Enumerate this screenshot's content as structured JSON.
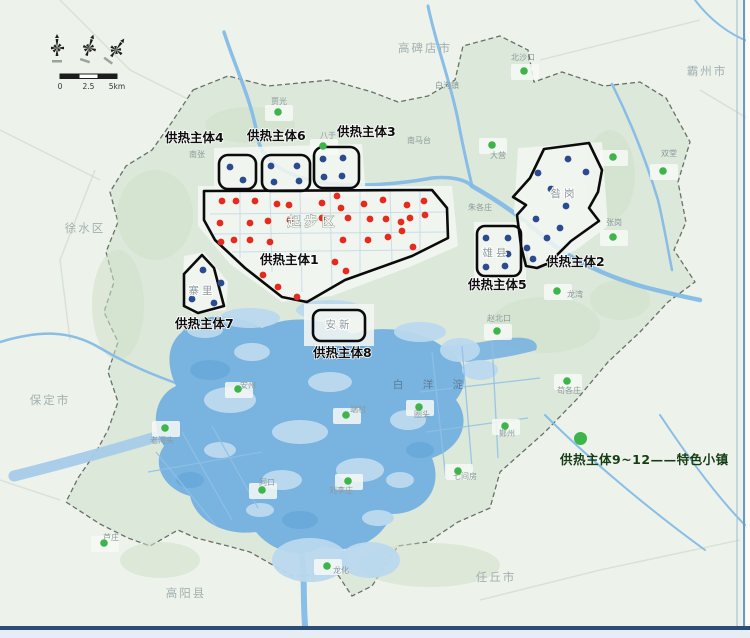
{
  "colors": {
    "bg_outside": "#edf2ea",
    "bg_inside": "#dce8da",
    "texture": "#cfe0ca",
    "built": "#f3f6f1",
    "water": "#79b3e0",
    "water_light": "#b9d8ee",
    "water_deep": "#63a6d8",
    "river": "#84bbe6",
    "canal_band": "#a6cbe9",
    "boundary": "#6a6f6a",
    "zone_stroke": "#0b0b0b",
    "red_dot": "#e42b1e",
    "blue_dot": "#2c4a8e",
    "green_dot": "#3db54a",
    "zone_label": "#0d0d0d",
    "city_label": "#a2b0b2",
    "town_label": "#8b9a9b",
    "area_label": "#8d9a9e",
    "lake_label": "#5c7a94",
    "legend_text": "#153d15",
    "frame_dark": "#2c4d74",
    "frame_light": "#6d99c4"
  },
  "legend": {
    "text": "供热主体9~12——特色小镇"
  },
  "scalebar": {
    "ticks": [
      "0",
      "2.5",
      "5km"
    ]
  },
  "zone_labels": [
    {
      "text": "供热主体4",
      "x": 165,
      "y": 142
    },
    {
      "text": "供热主体6",
      "x": 247,
      "y": 140
    },
    {
      "text": "供热主体3",
      "x": 337,
      "y": 136
    },
    {
      "text": "供热主体1",
      "x": 260,
      "y": 264
    },
    {
      "text": "供热主体7",
      "x": 175,
      "y": 328
    },
    {
      "text": "供热主体8",
      "x": 313,
      "y": 357
    },
    {
      "text": "供热主体5",
      "x": 468,
      "y": 289
    },
    {
      "text": "供热主体2",
      "x": 546,
      "y": 266
    }
  ],
  "city_labels": [
    {
      "text": "高碑店市",
      "x": 425,
      "y": 52
    },
    {
      "text": "霸州市",
      "x": 707,
      "y": 75
    },
    {
      "text": "徐水区",
      "x": 85,
      "y": 232
    },
    {
      "text": "保定市",
      "x": 50,
      "y": 404
    },
    {
      "text": "高阳县",
      "x": 186,
      "y": 597
    },
    {
      "text": "任丘市",
      "x": 496,
      "y": 581
    }
  ],
  "area_labels": [
    {
      "text": "起步区",
      "x": 313,
      "y": 226,
      "big": true
    },
    {
      "text": "昝岗",
      "x": 564,
      "y": 197
    },
    {
      "text": "雄县",
      "x": 496,
      "y": 256
    },
    {
      "text": "安新",
      "x": 339,
      "y": 328
    },
    {
      "text": "寨里",
      "x": 202,
      "y": 294
    }
  ],
  "lake_label": {
    "text": "白 洋 淀",
    "x": 432,
    "y": 388
  },
  "town_labels": [
    {
      "text": "白沟镇",
      "x": 447,
      "y": 88
    },
    {
      "text": "北沙口",
      "x": 523,
      "y": 60
    },
    {
      "text": "贾光",
      "x": 279,
      "y": 104
    },
    {
      "text": "八于",
      "x": 328,
      "y": 138
    },
    {
      "text": "南马台",
      "x": 419,
      "y": 143
    },
    {
      "text": "南张",
      "x": 197,
      "y": 157
    },
    {
      "text": "大营",
      "x": 498,
      "y": 158
    },
    {
      "text": "朱各庄",
      "x": 480,
      "y": 210
    },
    {
      "text": "双堂",
      "x": 669,
      "y": 156
    },
    {
      "text": "张岗",
      "x": 614,
      "y": 225
    },
    {
      "text": "龙湾",
      "x": 575,
      "y": 297
    },
    {
      "text": "赵北口",
      "x": 499,
      "y": 321
    },
    {
      "text": "苟各庄",
      "x": 569,
      "y": 393
    },
    {
      "text": "鄚州",
      "x": 507,
      "y": 436
    },
    {
      "text": "七间房",
      "x": 465,
      "y": 479
    },
    {
      "text": "圈头",
      "x": 422,
      "y": 417
    },
    {
      "text": "端村",
      "x": 358,
      "y": 412
    },
    {
      "text": "安州",
      "x": 248,
      "y": 388
    },
    {
      "text": "同口",
      "x": 267,
      "y": 485
    },
    {
      "text": "刘李庄",
      "x": 341,
      "y": 493
    },
    {
      "text": "老河头",
      "x": 162,
      "y": 443
    },
    {
      "text": "芦庄",
      "x": 111,
      "y": 540
    },
    {
      "text": "龙化",
      "x": 341,
      "y": 573
    }
  ],
  "green_dots": [
    [
      278,
      112
    ],
    [
      323,
      146
    ],
    [
      524,
      71
    ],
    [
      492,
      145
    ],
    [
      663,
      171
    ],
    [
      613,
      157
    ],
    [
      613,
      237
    ],
    [
      557,
      291
    ],
    [
      497,
      331
    ],
    [
      567,
      381
    ],
    [
      505,
      426
    ],
    [
      458,
      471
    ],
    [
      419,
      407
    ],
    [
      346,
      415
    ],
    [
      238,
      389
    ],
    [
      262,
      490
    ],
    [
      348,
      481
    ],
    [
      165,
      428
    ],
    [
      327,
      566
    ],
    [
      104,
      543
    ]
  ],
  "red_dots": [
    [
      222,
      201
    ],
    [
      236,
      201
    ],
    [
      255,
      201
    ],
    [
      277,
      204
    ],
    [
      289,
      205
    ],
    [
      322,
      203
    ],
    [
      337,
      196
    ],
    [
      341,
      208
    ],
    [
      364,
      204
    ],
    [
      383,
      200
    ],
    [
      407,
      205
    ],
    [
      424,
      201
    ],
    [
      220,
      223
    ],
    [
      250,
      223
    ],
    [
      268,
      221
    ],
    [
      290,
      220
    ],
    [
      322,
      218
    ],
    [
      348,
      218
    ],
    [
      370,
      219
    ],
    [
      386,
      219
    ],
    [
      401,
      222
    ],
    [
      410,
      218
    ],
    [
      425,
      215
    ],
    [
      221,
      242
    ],
    [
      234,
      240
    ],
    [
      250,
      240
    ],
    [
      270,
      242
    ],
    [
      343,
      240
    ],
    [
      368,
      240
    ],
    [
      388,
      237
    ],
    [
      402,
      231
    ],
    [
      413,
      247
    ],
    [
      335,
      262
    ],
    [
      346,
      271
    ],
    [
      263,
      275
    ],
    [
      278,
      287
    ],
    [
      297,
      297
    ]
  ],
  "blue_dots": [
    [
      230,
      167
    ],
    [
      243,
      180
    ],
    [
      271,
      166
    ],
    [
      297,
      166
    ],
    [
      274,
      182
    ],
    [
      299,
      181
    ],
    [
      323,
      159
    ],
    [
      343,
      158
    ],
    [
      324,
      177
    ],
    [
      342,
      176
    ],
    [
      203,
      270
    ],
    [
      192,
      299
    ],
    [
      214,
      303
    ],
    [
      221,
      283
    ],
    [
      486,
      238
    ],
    [
      508,
      238
    ],
    [
      508,
      254
    ],
    [
      486,
      267
    ],
    [
      505,
      266
    ],
    [
      568,
      159
    ],
    [
      538,
      173
    ],
    [
      586,
      172
    ],
    [
      551,
      189
    ],
    [
      566,
      206
    ],
    [
      536,
      219
    ],
    [
      547,
      238
    ],
    [
      527,
      248
    ],
    [
      533,
      259
    ],
    [
      560,
      228
    ]
  ],
  "zones": {
    "polygons": [
      {
        "name": "zone-1-outline",
        "d": "M204,191 L432,190 L447,208 L448,238 L412,256 L345,280 L307,302 L282,297 L245,268 L215,240 L204,220 Z"
      },
      {
        "name": "zone-7-outline",
        "d": "M202,255 L184,274 L184,306 L198,313 L224,306 L214,268 Z"
      },
      {
        "name": "zone-2-outline",
        "d": "M544,149 L589,143 L602,170 L598,192 L589,208 L599,221 L571,241 L549,263 L537,268 L526,266 L521,246 L517,215 L526,205 L513,197 L530,178 Z"
      }
    ],
    "boxes": [
      {
        "name": "zone-4-box",
        "x": 219,
        "y": 155,
        "w": 37,
        "h": 34,
        "r": 9
      },
      {
        "name": "zone-6-box",
        "x": 262,
        "y": 155,
        "w": 48,
        "h": 36,
        "r": 9
      },
      {
        "name": "zone-3-box",
        "x": 314,
        "y": 147,
        "w": 45,
        "h": 41,
        "r": 9
      },
      {
        "name": "zone-8-box",
        "x": 313,
        "y": 310,
        "w": 52,
        "h": 31,
        "r": 8
      },
      {
        "name": "zone-5-box",
        "x": 477,
        "y": 226,
        "w": 44,
        "h": 50,
        "r": 8
      }
    ]
  },
  "geo": {
    "region": "M193,90 L228,76 L268,86 L330,80 L372,92 L398,102 L428,96 L455,80 L463,46 L500,36 L528,50 L534,82 L562,72 L604,86 L640,82 L666,98 L690,142 L678,182 L686,222 L674,250 L695,282 L668,302 L640,332 L608,362 L578,398 L545,432 L500,472 L490,508 L458,522 L428,542 L398,546 L372,586 L352,596 L332,566 L308,576 L292,576 L250,552 L228,546 L196,538 L178,530 L150,546 L128,538 L100,524 L66,502 L78,478 L96,452 L108,430 L118,402 L108,372 L118,342 L104,312 L114,282 L106,252 L118,222 L110,192 L126,166 L152,150 L172,122 Z",
    "texture_blobs": [
      [
        155,
        215,
        38,
        45
      ],
      [
        118,
        305,
        26,
        55
      ],
      [
        250,
        125,
        45,
        18
      ],
      [
        545,
        325,
        55,
        28
      ],
      [
        610,
        175,
        25,
        45
      ],
      [
        430,
        565,
        70,
        22
      ],
      [
        160,
        560,
        40,
        18
      ],
      [
        620,
        300,
        30,
        20
      ]
    ],
    "built_patches": [
      "M198,186 L452,186 L458,246 L412,266 L332,296 L282,302 L230,264 L198,226 Z",
      "M214,148 L362,144 L366,196 L214,200 Z",
      "M518,148 L602,142 L608,226 L576,250 L532,270 L514,212 Z",
      "M474,222 L526,222 L526,280 L474,280 Z",
      "M304,304 L374,304 L374,346 L304,346 Z",
      "M184,256 L204,252 L228,282 L226,310 L192,314 L182,300 Z"
    ],
    "outer_roads": [
      "M60,0 L130,70 L190,100",
      "M0,130 L100,180",
      "M540,60 L620,40 L700,20",
      "M700,90 L750,120",
      "M0,480 L60,500",
      "M480,600 L600,570 L740,540",
      "M95,170 L60,260 L70,340"
    ],
    "rivers": [
      {
        "d": "M14,476 C70,462 120,448 186,428",
        "w": 11,
        "c": "#a6cbe9"
      },
      {
        "d": "M224,32 C236,70 252,100 258,140 C264,162 286,176 320,182 C356,188 400,184 432,178 C452,176 466,180 472,186",
        "w": 3.5
      },
      {
        "d": "M428,6 C436,45 450,80 458,120 C463,148 468,168 472,186",
        "w": 3
      },
      {
        "d": "M472,186 C500,202 520,216 545,238 C570,260 610,278 648,288 C668,293 685,297 700,300",
        "w": 4.5
      },
      {
        "d": "M0,342 C40,330 70,330 100,348 C130,366 160,378 196,390",
        "w": 2.5
      },
      {
        "d": "M300,545 C306,570 302,600 306,638",
        "w": 6
      },
      {
        "d": "M545,415 C590,460 650,510 705,550",
        "w": 2
      },
      {
        "d": "M660,415 C690,460 720,500 745,525",
        "w": 2
      },
      {
        "d": "M612,84 C630,120 646,160 658,200 C664,225 668,250 672,270",
        "w": 2.5
      },
      {
        "d": "M695,0 C710,20 730,35 750,42",
        "w": 2
      }
    ],
    "lake": "M182,332 C196,312 236,312 262,328 C288,314 330,318 352,334 C382,324 420,330 442,346 C464,356 472,380 456,400 C472,420 462,448 432,458 C444,488 424,514 392,514 C382,540 352,556 322,546 C302,560 272,552 256,532 C226,536 196,522 190,496 C166,490 150,466 164,446 C150,426 154,396 176,386 C164,360 170,342 182,332 Z",
    "lake_arm": "M442,346 C470,345 490,340 510,338 C530,336 540,342 536,350 C516,356 490,360 466,362 Z",
    "marsh_blobs": [
      [
        250,
        318,
        30,
        10
      ],
      [
        330,
        310,
        34,
        10
      ],
      [
        420,
        332,
        26,
        10
      ],
      [
        460,
        350,
        20,
        12
      ],
      [
        480,
        370,
        18,
        10
      ],
      [
        205,
        330,
        18,
        8
      ],
      [
        310,
        560,
        38,
        22
      ],
      [
        370,
        560,
        30,
        18
      ]
    ],
    "islands": [
      [
        230,
        400,
        26,
        13
      ],
      [
        300,
        432,
        28,
        12
      ],
      [
        360,
        470,
        24,
        12
      ],
      [
        282,
        480,
        20,
        10
      ],
      [
        408,
        420,
        18,
        10
      ],
      [
        330,
        382,
        22,
        10
      ],
      [
        252,
        352,
        18,
        9
      ],
      [
        378,
        518,
        16,
        8
      ],
      [
        220,
        450,
        16,
        8
      ],
      [
        260,
        510,
        14,
        7
      ],
      [
        400,
        480,
        14,
        8
      ]
    ],
    "deep_spots": [
      [
        210,
        370,
        20,
        10
      ],
      [
        340,
        350,
        26,
        10
      ],
      [
        300,
        520,
        18,
        9
      ],
      [
        420,
        450,
        14,
        8
      ],
      [
        190,
        480,
        14,
        8
      ]
    ],
    "canal_grid": [
      "M432,352 L446,480",
      "M462,346 L472,468",
      "M492,342 L498,458",
      "M420,392 L540,378",
      "M426,432 L528,418",
      "M182,432 L232,520",
      "M212,426 L258,508",
      "M156,452 L216,526",
      "M148,472 L262,452"
    ],
    "city_grid": [
      "M240,192 L240,258",
      "M270,192 L272,272",
      "M300,190 L302,292",
      "M330,190 L332,290",
      "M360,190 L360,276",
      "M390,190 L392,262",
      "M420,190 L420,252",
      "M210,214 L448,212",
      "M214,234 L446,232",
      "M232,252 L420,250"
    ]
  }
}
